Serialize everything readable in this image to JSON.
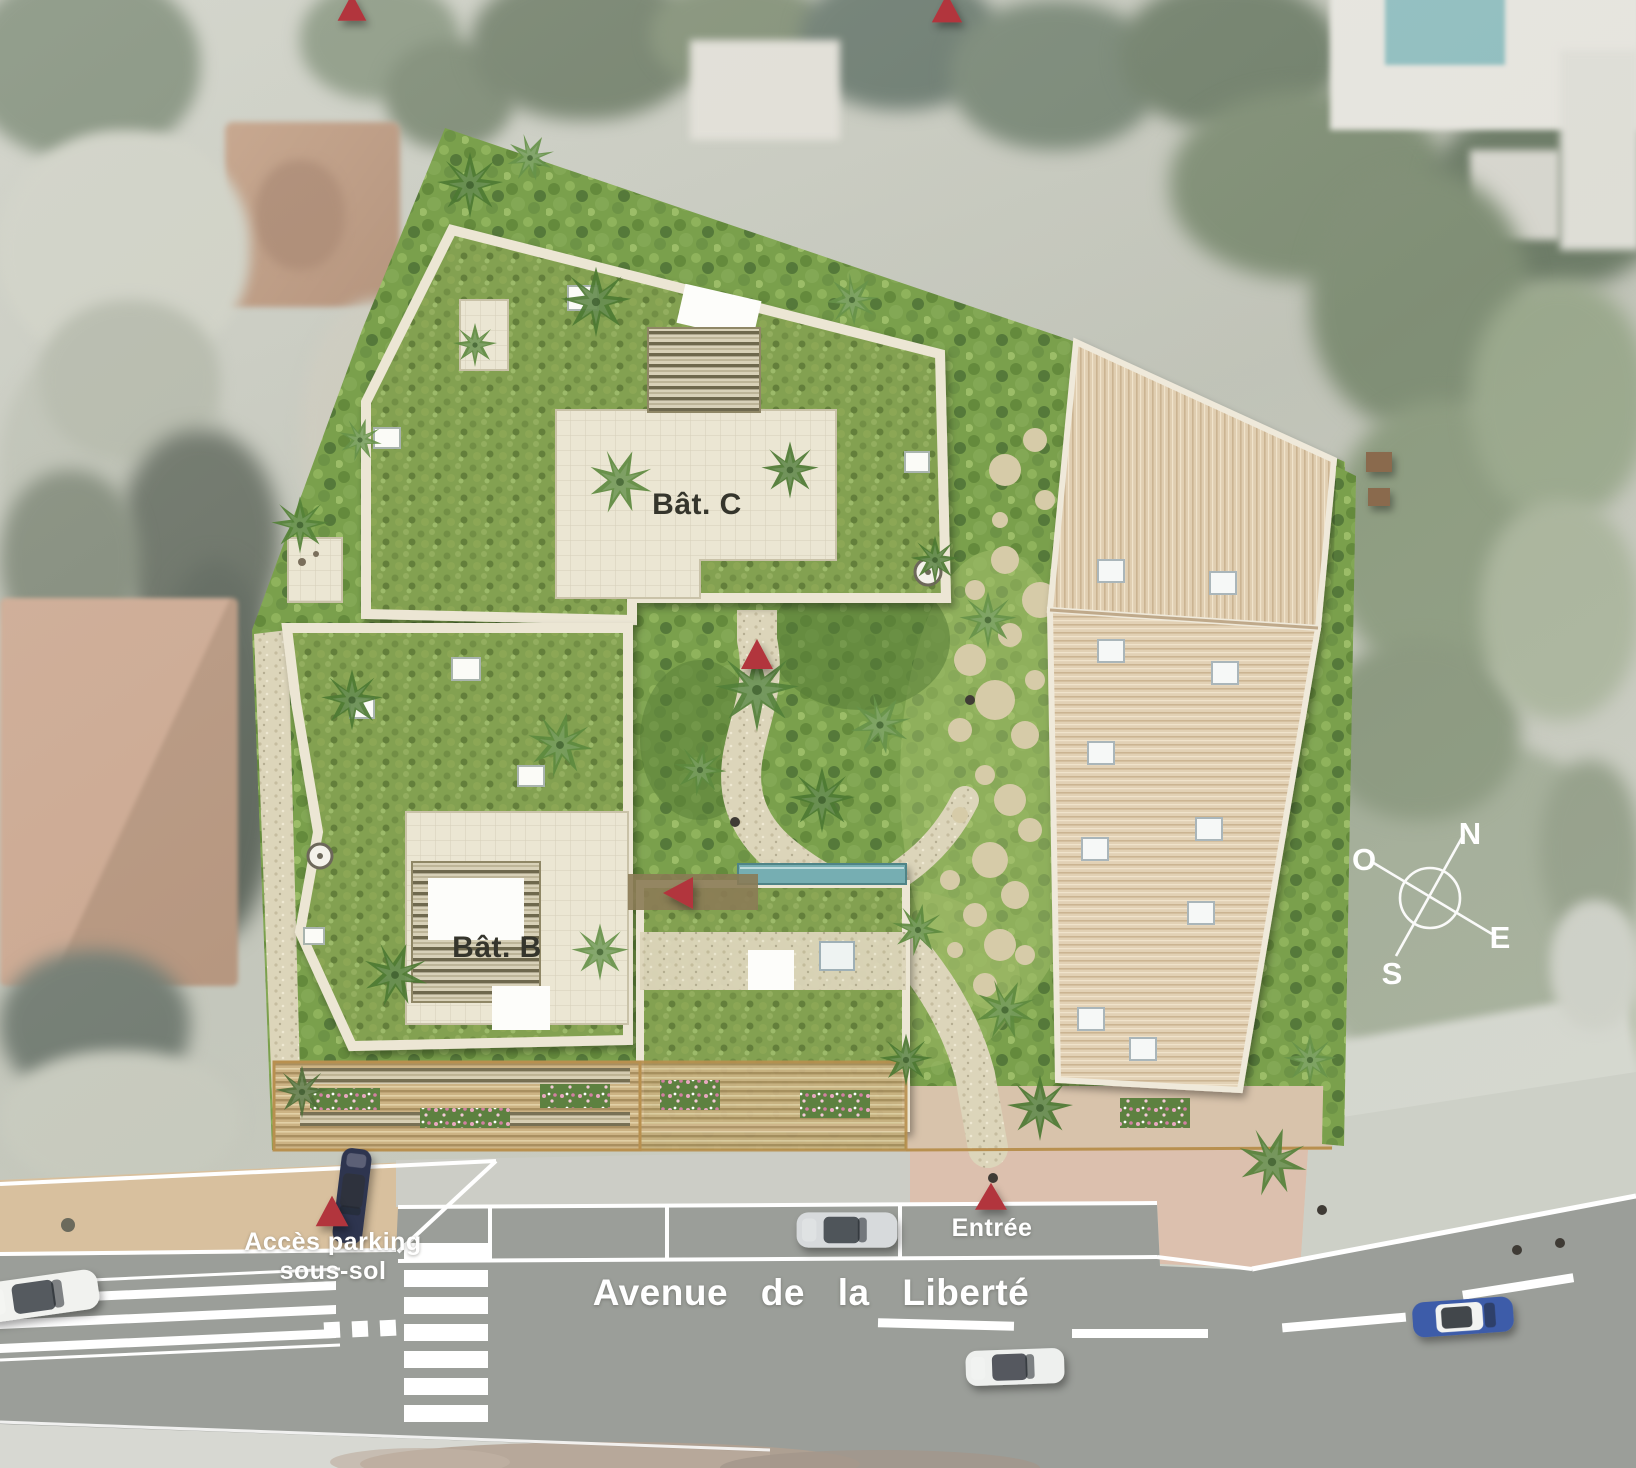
{
  "plan": {
    "buildings": {
      "bat_b": "Bât. B",
      "bat_c": "Bât. C"
    },
    "street_name": "Avenue de la Liberté",
    "labels": {
      "parking_line1": "Accès parking",
      "parking_line2": "sous-sol",
      "entrance": "Entrée"
    },
    "compass": {
      "n": "N",
      "e": "E",
      "s": "S",
      "w": "O"
    },
    "markers": [
      {
        "id": "access-top-left",
        "shape": "red-triangle-up"
      },
      {
        "id": "access-top-center",
        "shape": "red-triangle-up"
      },
      {
        "id": "garden-path-access",
        "shape": "red-triangle-up"
      },
      {
        "id": "bat-b-entrance",
        "shape": "red-triangle-left"
      },
      {
        "id": "parking-access",
        "shape": "red-triangle-up"
      },
      {
        "id": "main-entrance",
        "shape": "red-triangle-up"
      }
    ],
    "vehicles": [
      "white-car-parked",
      "navy-car-parking-access",
      "silver-car-parked",
      "white-car-driving",
      "blue-car-driving"
    ],
    "colors": {
      "marker_red": "#b2363d",
      "roof_green": "#83a151",
      "garden_green": "#7aa04c",
      "terrace_tile": "#ebe6d3",
      "gravel": "#dcd5ba",
      "tan_roof": "#e0ceb1",
      "road": "#9b9e99",
      "sand_sidewalk": "#d8c09e",
      "pink_sidewalk": "#dcc0ae",
      "pool": "#76aeb2",
      "label_dark": "#35352c",
      "label_white": "#ffffff"
    }
  }
}
